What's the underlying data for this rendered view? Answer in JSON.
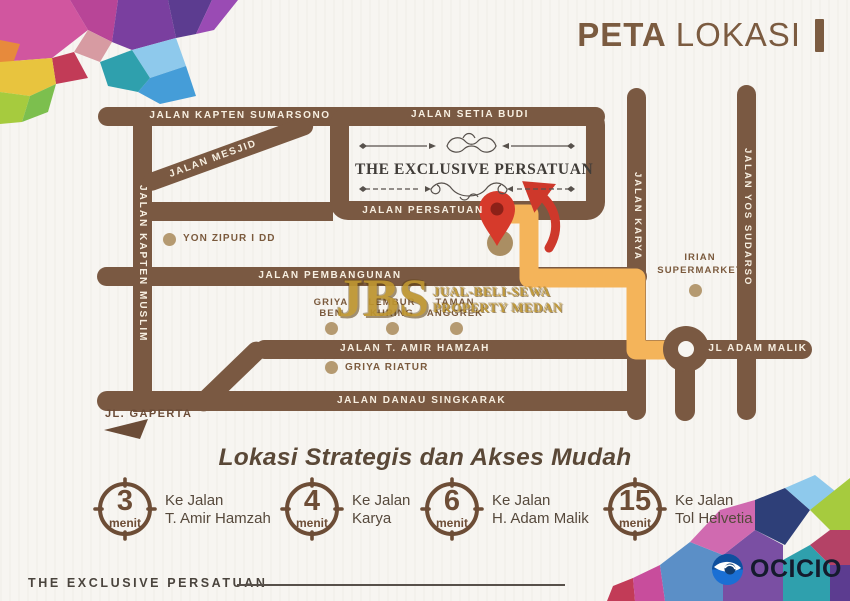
{
  "page": {
    "title_bold": "PETA",
    "title_light": "LOKASI"
  },
  "map": {
    "roads": {
      "sumarsono": "JALAN KAPTEN SUMARSONO",
      "setia_budi": "JALAN SETIA BUDI",
      "mesjid": "JALAN MESJID",
      "kapten_muslim": "JALAN KAPTEN MUSLIM",
      "persatuan": "JALAN PERSATUAN",
      "pembangunan": "JALAN PEMBANGUNAN",
      "amir_hamzah": "JALAN T. AMIR HAMZAH",
      "adam_malik": "JL ADAM MALIK",
      "danau_singkarak": "JALAN DANAU SINGKARAK",
      "karya": "JALAN KARYA",
      "yos_sudarso": "JALAN YOS SUDARSO",
      "gaperta": "JL. GAPERTA"
    },
    "landmarks": [
      {
        "line1": "YON ZIPUR I DD",
        "line2": ""
      },
      {
        "line1": "GRIYA",
        "line2": "BEN"
      },
      {
        "line1": "LEMBUR",
        "line2": "KURING"
      },
      {
        "line1": "TAMAN",
        "line2": "ANGGREK"
      },
      {
        "line1": "GRIYA RIATUR",
        "line2": ""
      },
      {
        "line1": "IRIAN",
        "line2": "SUPERMARKET"
      }
    ],
    "property_name": "THE EXCLUSIVE PERSATUAN",
    "watermark": {
      "abbr": "JBS",
      "line1": "JUAL-BELI-SEWA",
      "line2": "PROPERTY MEDAN"
    }
  },
  "tagline": "Lokasi Strategis dan Akses Mudah",
  "badges": [
    {
      "number": "3",
      "unit": "menit",
      "line1": "Ke Jalan",
      "line2": "T. Amir Hamzah"
    },
    {
      "number": "4",
      "unit": "menit",
      "line1": "Ke Jalan",
      "line2": "Karya"
    },
    {
      "number": "6",
      "unit": "menit",
      "line1": "Ke Jalan",
      "line2": "H. Adam Malik"
    },
    {
      "number": "15",
      "unit": "menit",
      "line1": "Ke Jalan",
      "line2": "Tol Helvetia"
    }
  ],
  "footer": {
    "brand": "THE EXCLUSIVE PERSATUAN",
    "logo_text": "OCICIO"
  },
  "colors": {
    "road": "#7a5942",
    "route": "#f4b45a",
    "pin": "#d63a2b",
    "gold": "#bd9530",
    "logo_blue": "#1a6fd4"
  }
}
